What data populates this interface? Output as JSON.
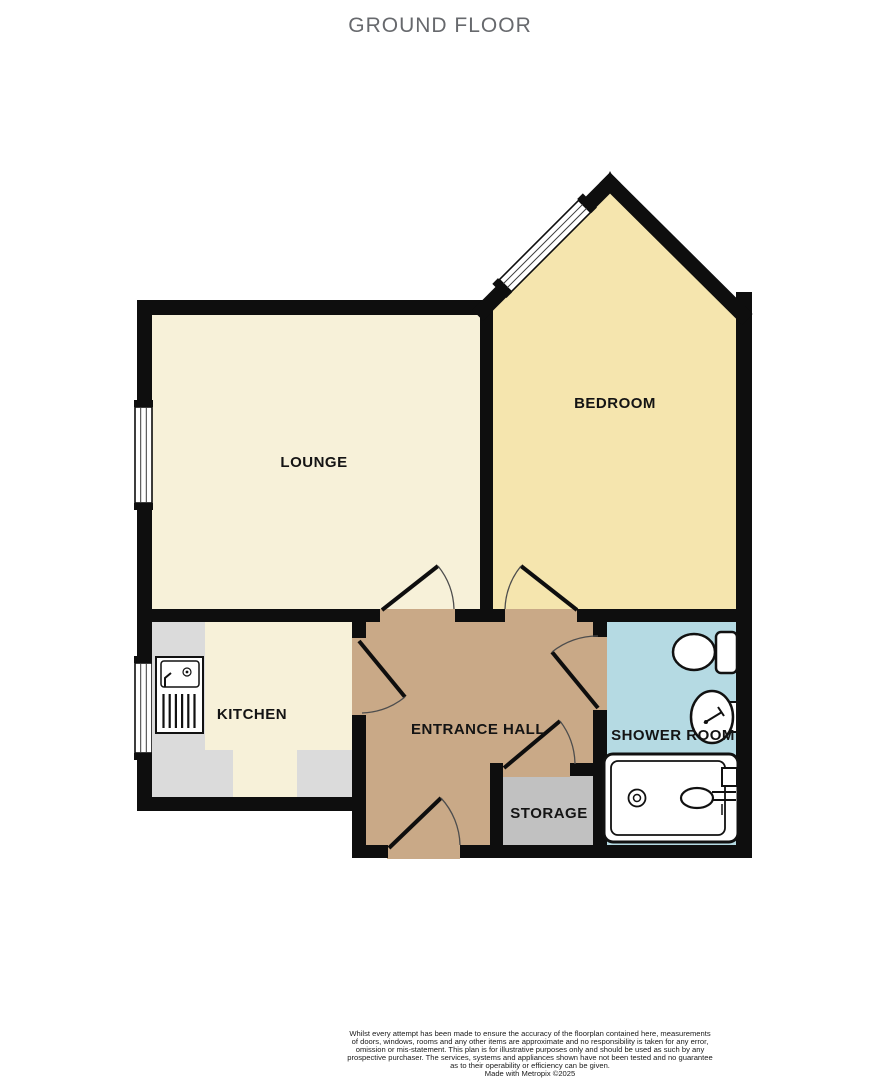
{
  "title": "GROUND FLOOR",
  "plan": {
    "wall_color": "#0e0e0e",
    "counter_color": "#DBDBDB",
    "rooms": [
      {
        "id": "lounge",
        "label": "LOUNGE",
        "color": "#F7F1D9"
      },
      {
        "id": "bedroom",
        "label": "BEDROOM",
        "color": "#F5E5AE"
      },
      {
        "id": "kitchen",
        "label": "KITCHEN",
        "color": "#F7F1D9"
      },
      {
        "id": "entrance_hall",
        "label": "ENTRANCE HALL",
        "color": "#C9A987"
      },
      {
        "id": "shower_room",
        "label": "SHOWER ROOM",
        "color": "#B5DAE3"
      },
      {
        "id": "storage",
        "label": "STORAGE",
        "color": "#C1C1C1"
      }
    ],
    "fixtures": [
      "kitchen-sink",
      "toilet",
      "basin",
      "shower-tray"
    ]
  },
  "footer": {
    "lines": [
      "Whilst every attempt has been made to ensure the accuracy of the floorplan contained here, measurements",
      "of doors, windows, rooms and any other items are approximate and no responsibility is taken for any error,",
      "omission or mis-statement. This plan is for illustrative purposes only and should be used as such by any",
      "prospective purchaser. The services, systems and appliances shown have not been tested and no guarantee",
      "as to their operability or efficiency can be given.",
      "Made with Metropix ©2025"
    ]
  }
}
